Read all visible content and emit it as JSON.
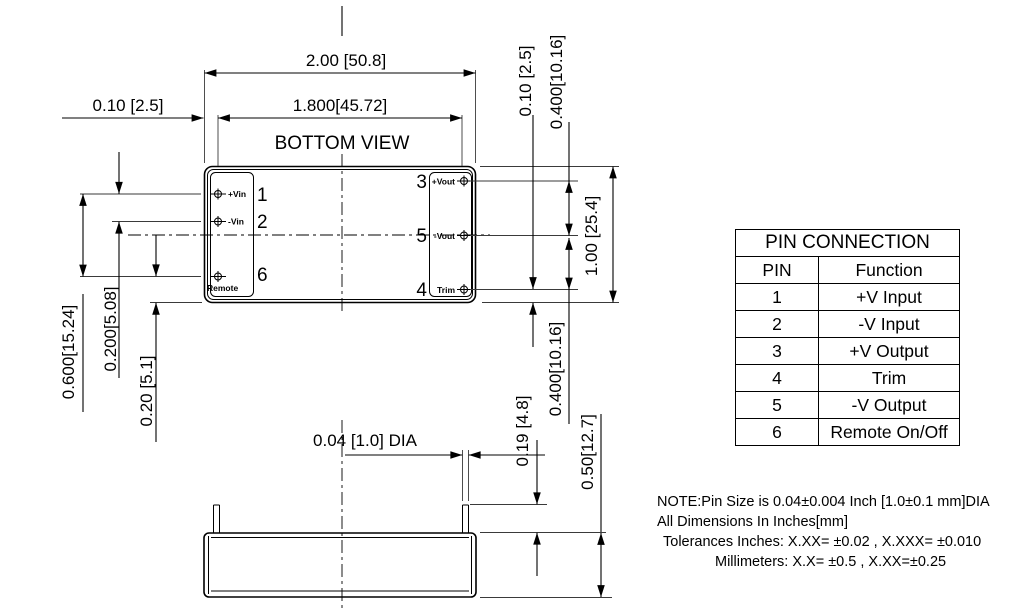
{
  "drawing": {
    "view_title": "BOTTOM VIEW",
    "dimensions": {
      "overall_width": "2.00 [50.8]",
      "pin_row_span": "1.800[45.72]",
      "edge_to_pin_col": "0.10 [2.5]",
      "edge_to_pin_row": "0.10 [2.5]",
      "pin3_to_pin5": "0.400[10.16]",
      "overall_height": "1.00 [25.4]",
      "pin5_to_pin4": "0.400[10.16]",
      "pin1_to_pin6": "0.600[15.24]",
      "pin1_to_pin2": "0.200[5.08]",
      "pin6_to_bottom_edge": "0.20 [5.1]",
      "pin_length": "0.19 [4.8]",
      "case_height": "0.50[12.7]",
      "pin_diameter": "0.04 [1.0] DIA"
    },
    "module_pins": {
      "left": [
        {
          "number": "1",
          "label": "+Vin"
        },
        {
          "number": "2",
          "label": "-Vin"
        },
        {
          "number": "6",
          "label": "Remote"
        }
      ],
      "right": [
        {
          "number": "3",
          "label": "+Vout"
        },
        {
          "number": "5",
          "label": "-Vout"
        },
        {
          "number": "4",
          "label": "Trim"
        }
      ]
    }
  },
  "pin_table": {
    "title": "PIN CONNECTION",
    "headers": {
      "pin": "PIN",
      "function": "Function"
    },
    "rows": [
      {
        "pin": "1",
        "function": "+V Input"
      },
      {
        "pin": "2",
        "function": "-V Input"
      },
      {
        "pin": "3",
        "function": "+V Output"
      },
      {
        "pin": "4",
        "function": "Trim"
      },
      {
        "pin": "5",
        "function": "-V Output"
      },
      {
        "pin": "6",
        "function": "Remote On/Off"
      }
    ]
  },
  "notes": {
    "line1": "NOTE:Pin Size is 0.04±0.004 Inch [1.0±0.1 mm]DIA",
    "line2": "All Dimensions In Inches[mm]",
    "line3": "Tolerances Inches: X.XX= ±0.02 , X.XXX= ±0.010",
    "line4": "Millimeters: X.X= ±0.5 , X.XX=±0.25"
  }
}
